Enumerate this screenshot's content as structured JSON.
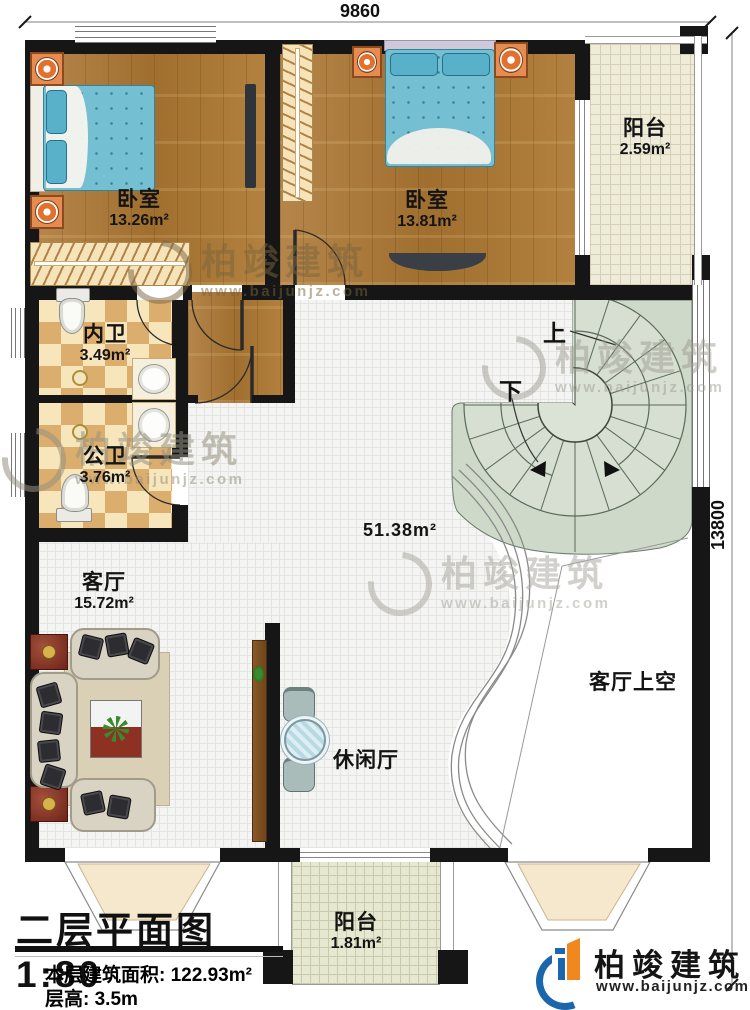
{
  "title_block": {
    "title": "二层平面图",
    "scale": "1:80",
    "area_label": "本层建筑面积:",
    "area_value": "122.93m²",
    "height_label": "层高:",
    "height_value": "3.5m"
  },
  "dimensions": {
    "width": "9860",
    "height": "13800"
  },
  "rooms": {
    "bedroom_left": {
      "name": "卧室",
      "area": "13.26m²"
    },
    "bedroom_right": {
      "name": "卧室",
      "area": "13.81m²"
    },
    "balcony_top": {
      "name": "阳台",
      "area": "2.59m²"
    },
    "bath_ensuite": {
      "name": "内卫",
      "area": "3.49m²"
    },
    "bath_public": {
      "name": "公卫",
      "area": "3.76m²"
    },
    "living_room": {
      "name": "客厅",
      "area": "15.72m²"
    },
    "hall": {
      "area": "51.38m²"
    },
    "leisure_hall": {
      "name": "休闲厅"
    },
    "living_void": {
      "name": "客厅上空"
    },
    "balcony_bottom": {
      "name": "阳台",
      "area": "1.81m²"
    }
  },
  "stairs": {
    "up_label": "上",
    "down_label": "下"
  },
  "brand": {
    "name": "柏竣建筑",
    "website": "www.baijunjz.com"
  },
  "watermark": {
    "name": "柏竣建筑",
    "website": "www.baijunjz.com"
  },
  "colors": {
    "wall": "#161616",
    "wood": "#ad7c3b",
    "tile": "#f4f4f2",
    "checker_dark": "#dcae6e",
    "checker_light": "#f7e6bc",
    "balcony_tile": "#eeebd8",
    "stair_area": "#cfd9ca",
    "bed": "#74bfd2",
    "brand_blue": "#1b66ad",
    "brand_orange": "#f0881f"
  }
}
